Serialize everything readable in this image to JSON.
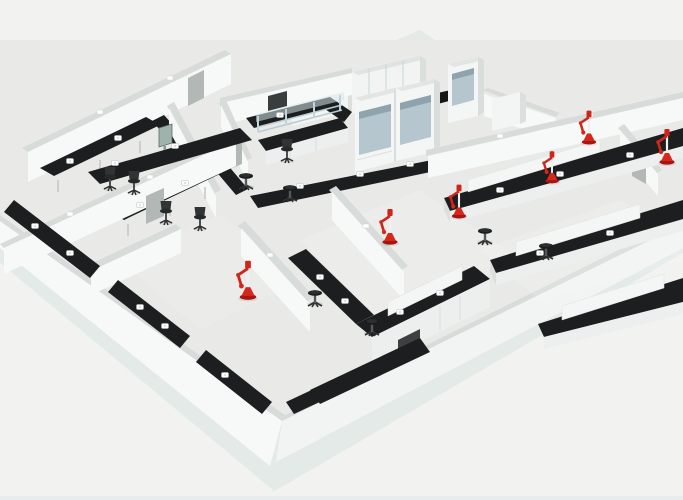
{
  "meta": {
    "description": "3D rendered cutaway view of a laboratory floor plan with white low walls, black epoxy benchtops, white cabinets, fume hoods, stools, office chairs and red emergency eyewash fixtures on a pale floor slab",
    "width": 683,
    "height": 500
  },
  "palette": {
    "background": "#f2f2f1",
    "platform": "#e4eae7",
    "floor": "#e9eae8",
    "wall_white": "#f7f9f8",
    "wall_cap": "#d7dbd9",
    "bench_top": "#1c1e1f",
    "bench_face": "#edefee",
    "fixture_red": "#d5271c",
    "fixture_red_dark": "#a81410",
    "sash_glass": "#b6c6cf",
    "shelf_steel": "#c2d3da",
    "monitor_green": "#9db3ac"
  },
  "scene": {
    "equipment_counts": {
      "eyewash_fixtures": 6,
      "stools": 6,
      "office_chairs": 5,
      "fume_hoods": 3,
      "bench_outlets": 24,
      "wall_cap_lights": 8
    },
    "eyewash_fixtures": [
      {
        "x": 390,
        "y": 242,
        "s": 1.0
      },
      {
        "x": 248,
        "y": 297,
        "s": 1.1
      },
      {
        "x": 459,
        "y": 216,
        "s": 0.95
      },
      {
        "x": 552,
        "y": 181,
        "s": 0.9
      },
      {
        "x": 589,
        "y": 142,
        "s": 0.95
      },
      {
        "x": 667,
        "y": 162,
        "s": 1.0
      }
    ],
    "stools": [
      [
        315,
        293
      ],
      [
        372,
        322
      ],
      [
        485,
        231
      ],
      [
        546,
        246
      ],
      [
        246,
        176
      ],
      [
        290,
        188
      ]
    ],
    "office_chairs": [
      [
        110,
        180
      ],
      [
        134,
        184
      ],
      [
        166,
        214
      ],
      [
        200,
        220
      ],
      [
        287,
        152
      ]
    ],
    "bench_outlets": [
      [
        115,
        163
      ],
      [
        175,
        146
      ],
      [
        300,
        186
      ],
      [
        360,
        174
      ],
      [
        410,
        164
      ],
      [
        70,
        161
      ],
      [
        118,
        138
      ],
      [
        140,
        205
      ],
      [
        185,
        183
      ],
      [
        35,
        226
      ],
      [
        70,
        253
      ],
      [
        140,
        307
      ],
      [
        165,
        326
      ],
      [
        225,
        375
      ],
      [
        280,
        115
      ],
      [
        320,
        277
      ],
      [
        345,
        301
      ],
      [
        400,
        312
      ],
      [
        440,
        293
      ],
      [
        500,
        190
      ],
      [
        560,
        174
      ],
      [
        630,
        155
      ],
      [
        540,
        253
      ],
      [
        610,
        233
      ]
    ],
    "wall_cap_lights": [
      [
        100,
        112
      ],
      [
        170,
        78
      ],
      [
        70,
        214
      ],
      [
        150,
        177
      ],
      [
        500,
        136
      ],
      [
        590,
        115
      ],
      [
        270,
        255
      ],
      [
        366,
        226
      ]
    ]
  }
}
